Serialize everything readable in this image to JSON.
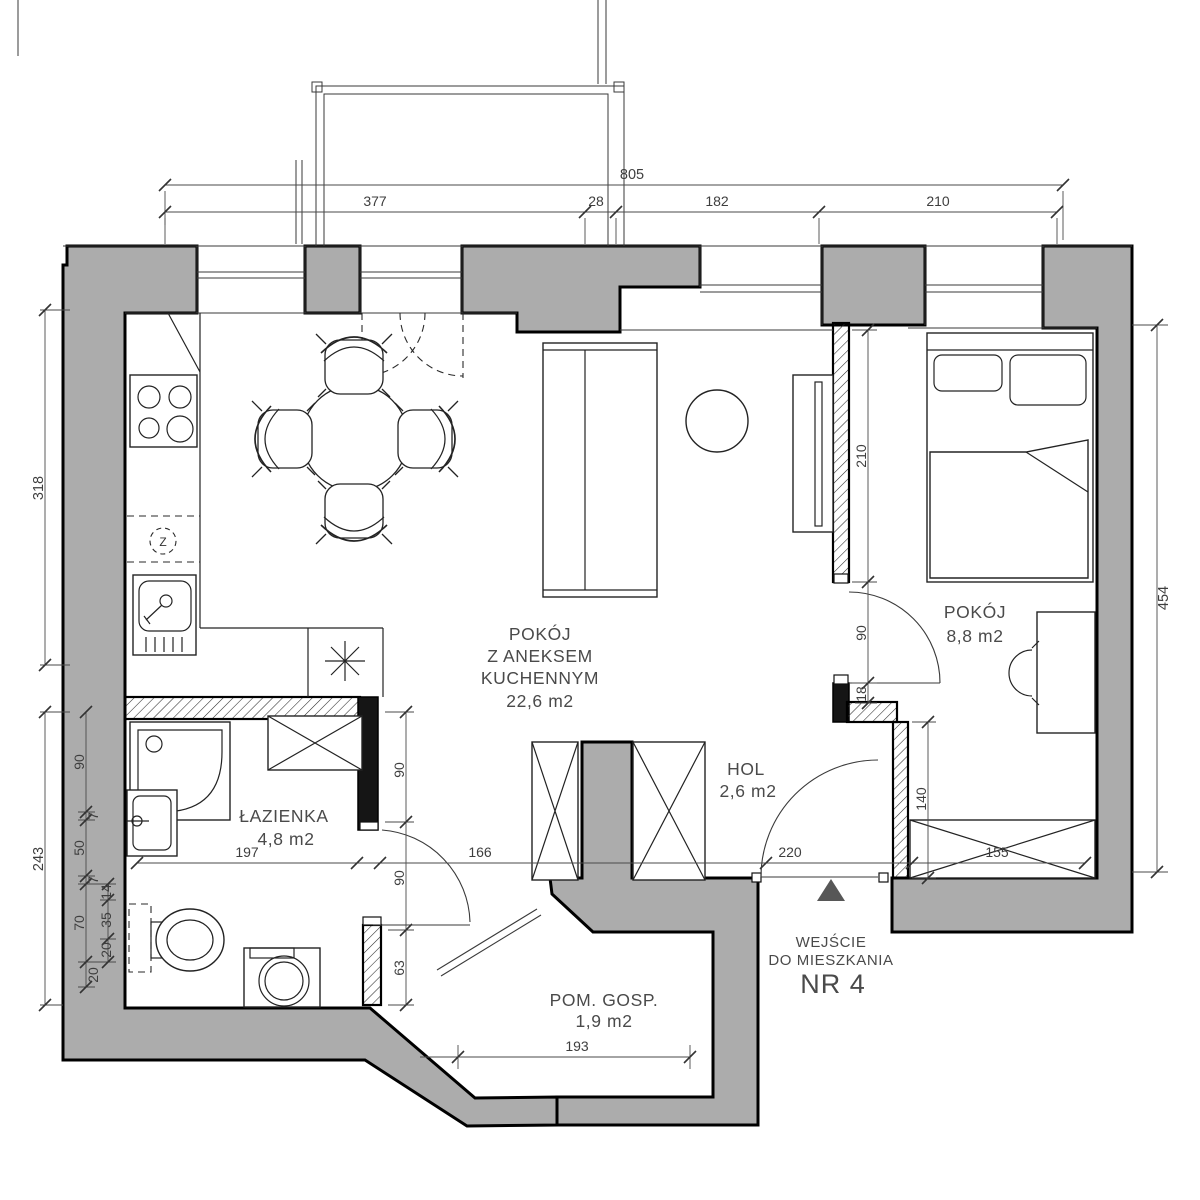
{
  "plan_type": "apartment-floor-plan",
  "rooms": {
    "living": {
      "line1": "POKÓJ",
      "line2": "Z ANEKSEM",
      "line3": "KUCHENNYM",
      "area": "22,6 m2"
    },
    "bedroom": {
      "name": "POKÓJ",
      "area": "8,8 m2"
    },
    "hol": {
      "name": "HOL",
      "area": "2,6 m2"
    },
    "bathroom": {
      "name": "ŁAZIENKA",
      "area": "4,8 m2"
    },
    "utility": {
      "name": "POM. GOSP.",
      "area": "1,9 m2"
    }
  },
  "entrance": {
    "line1": "WEJŚCIE",
    "line2": "DO MIESZKANIA",
    "line3": "NR 4"
  },
  "symbols": {
    "boiler": "Z"
  },
  "dims": {
    "top": [
      "805",
      "377",
      "28",
      "182",
      "210"
    ],
    "left": [
      "318",
      "243"
    ],
    "left_chain": [
      "90",
      "7",
      "50",
      "7",
      "70",
      "20"
    ],
    "left_sub": [
      "14",
      "35",
      "20"
    ],
    "right": [
      "454"
    ],
    "partition": [
      "210",
      "90",
      "18",
      "140"
    ],
    "bottom": [
      "197",
      "166",
      "220",
      "155"
    ],
    "bath": [
      "90",
      "90",
      "63"
    ],
    "utility": [
      "193"
    ]
  },
  "colors": {
    "wall_fill": "#ACACAC",
    "wall_stroke": "#000000",
    "label_text": "#4A4A4A",
    "dim_text": "#3E3E3E",
    "entrance_marker": "#575757"
  }
}
